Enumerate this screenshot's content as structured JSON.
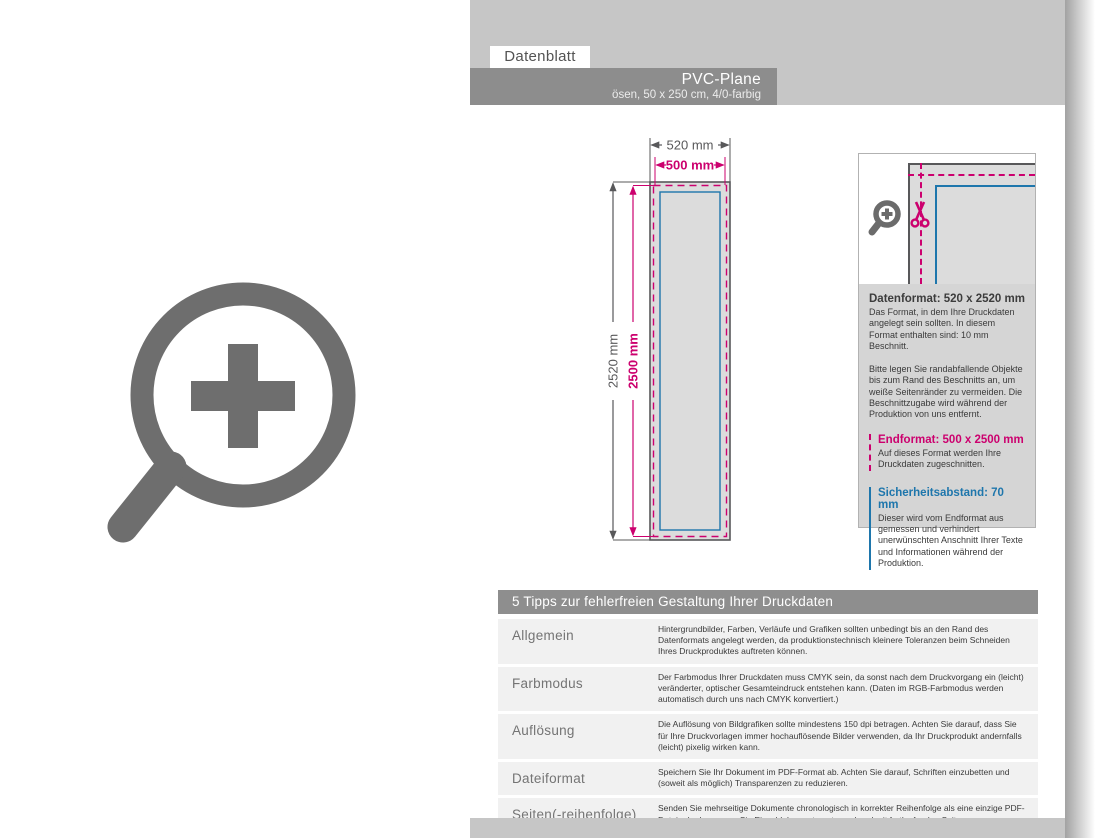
{
  "colors": {
    "page_light_gray": "#c6c6c6",
    "bar_gray": "#8d8d8d",
    "banner_fill": "#dcdcdc",
    "outline_gray": "#58585a",
    "magenta": "#cc006e",
    "blue": "#1e76ac",
    "infobox_bg": "#d5d5d5",
    "row_bg": "#f1f1f1",
    "icon_gray": "#6e6e6e"
  },
  "header": {
    "tab_label": "Datenblatt",
    "title": "PVC-Plane",
    "subtitle": "ösen, 50 x 250 cm, 4/0-farbig"
  },
  "diagram": {
    "width_outer": "520 mm",
    "width_inner": "500 mm",
    "height_outer": "2520 mm",
    "height_inner": "2500 mm"
  },
  "infobox": {
    "datenformat_title": "Datenformat: 520 x 2520 mm",
    "datenformat_p1": "Das Format, in dem Ihre Druckdaten angelegt sein sollten. In diesem Format enthalten sind: 10 mm Beschnitt.",
    "datenformat_p2": "Bitte legen Sie randabfallende Objekte bis zum Rand des Beschnitts an, um weiße Seitenränder zu vermeiden. Die Beschnittzugabe wird während der Produktion von uns entfernt.",
    "endformat_title": "Endformat: 500 x 2500 mm",
    "endformat_p": "Auf dieses Format werden Ihre Druckdaten zugeschnitten.",
    "sicherheit_title": "Sicherheitsabstand: 70 mm",
    "sicherheit_p": "Dieser wird vom Endformat aus gemessen und verhindert unerwünschten Anschnitt Ihrer Texte und Informationen während der Produktion."
  },
  "tips": {
    "title": "5 Tipps zur fehlerfreien Gestaltung Ihrer Druckdaten",
    "rows": [
      {
        "label": "Allgemein",
        "text": "Hintergrundbilder, Farben, Verläufe und Grafiken sollten unbedingt bis an den Rand des Datenformats angelegt werden, da produktionstechnisch kleinere Toleranzen beim Schneiden Ihres Druckproduktes auftreten können."
      },
      {
        "label": "Farbmodus",
        "text": "Der Farbmodus Ihrer Druckdaten muss CMYK sein, da sonst nach dem Druckvorgang ein (leicht) veränderter, optischer Gesamteindruck entstehen kann. (Daten im RGB-Farbmodus werden automatisch durch uns nach CMYK konvertiert.)"
      },
      {
        "label": "Auflösung",
        "text": "Die Auflösung von Bildgrafiken sollte mindestens 150 dpi betragen. Achten Sie darauf, dass Sie für Ihre Druckvorlagen immer hochauflösende Bilder verwenden, da Ihr Druckprodukt andernfalls (leicht) pixelig wirken kann."
      },
      {
        "label": "Dateiformat",
        "text": "Speichern Sie Ihr Dokument im PDF-Format ab. Achten Sie darauf, Schriften einzubetten und (soweit als möglich) Transparenzen zu reduzieren."
      },
      {
        "label": "Seiten(-reihenfolge)",
        "text": "Senden Sie mehrseitige Dokumente chronologisch in korrekter Reihenfolge als eine einzige PDF-Datei oder benennen Sie Einzeldokumente entsprechend mit fortlaufenden Seitennummern."
      }
    ]
  }
}
